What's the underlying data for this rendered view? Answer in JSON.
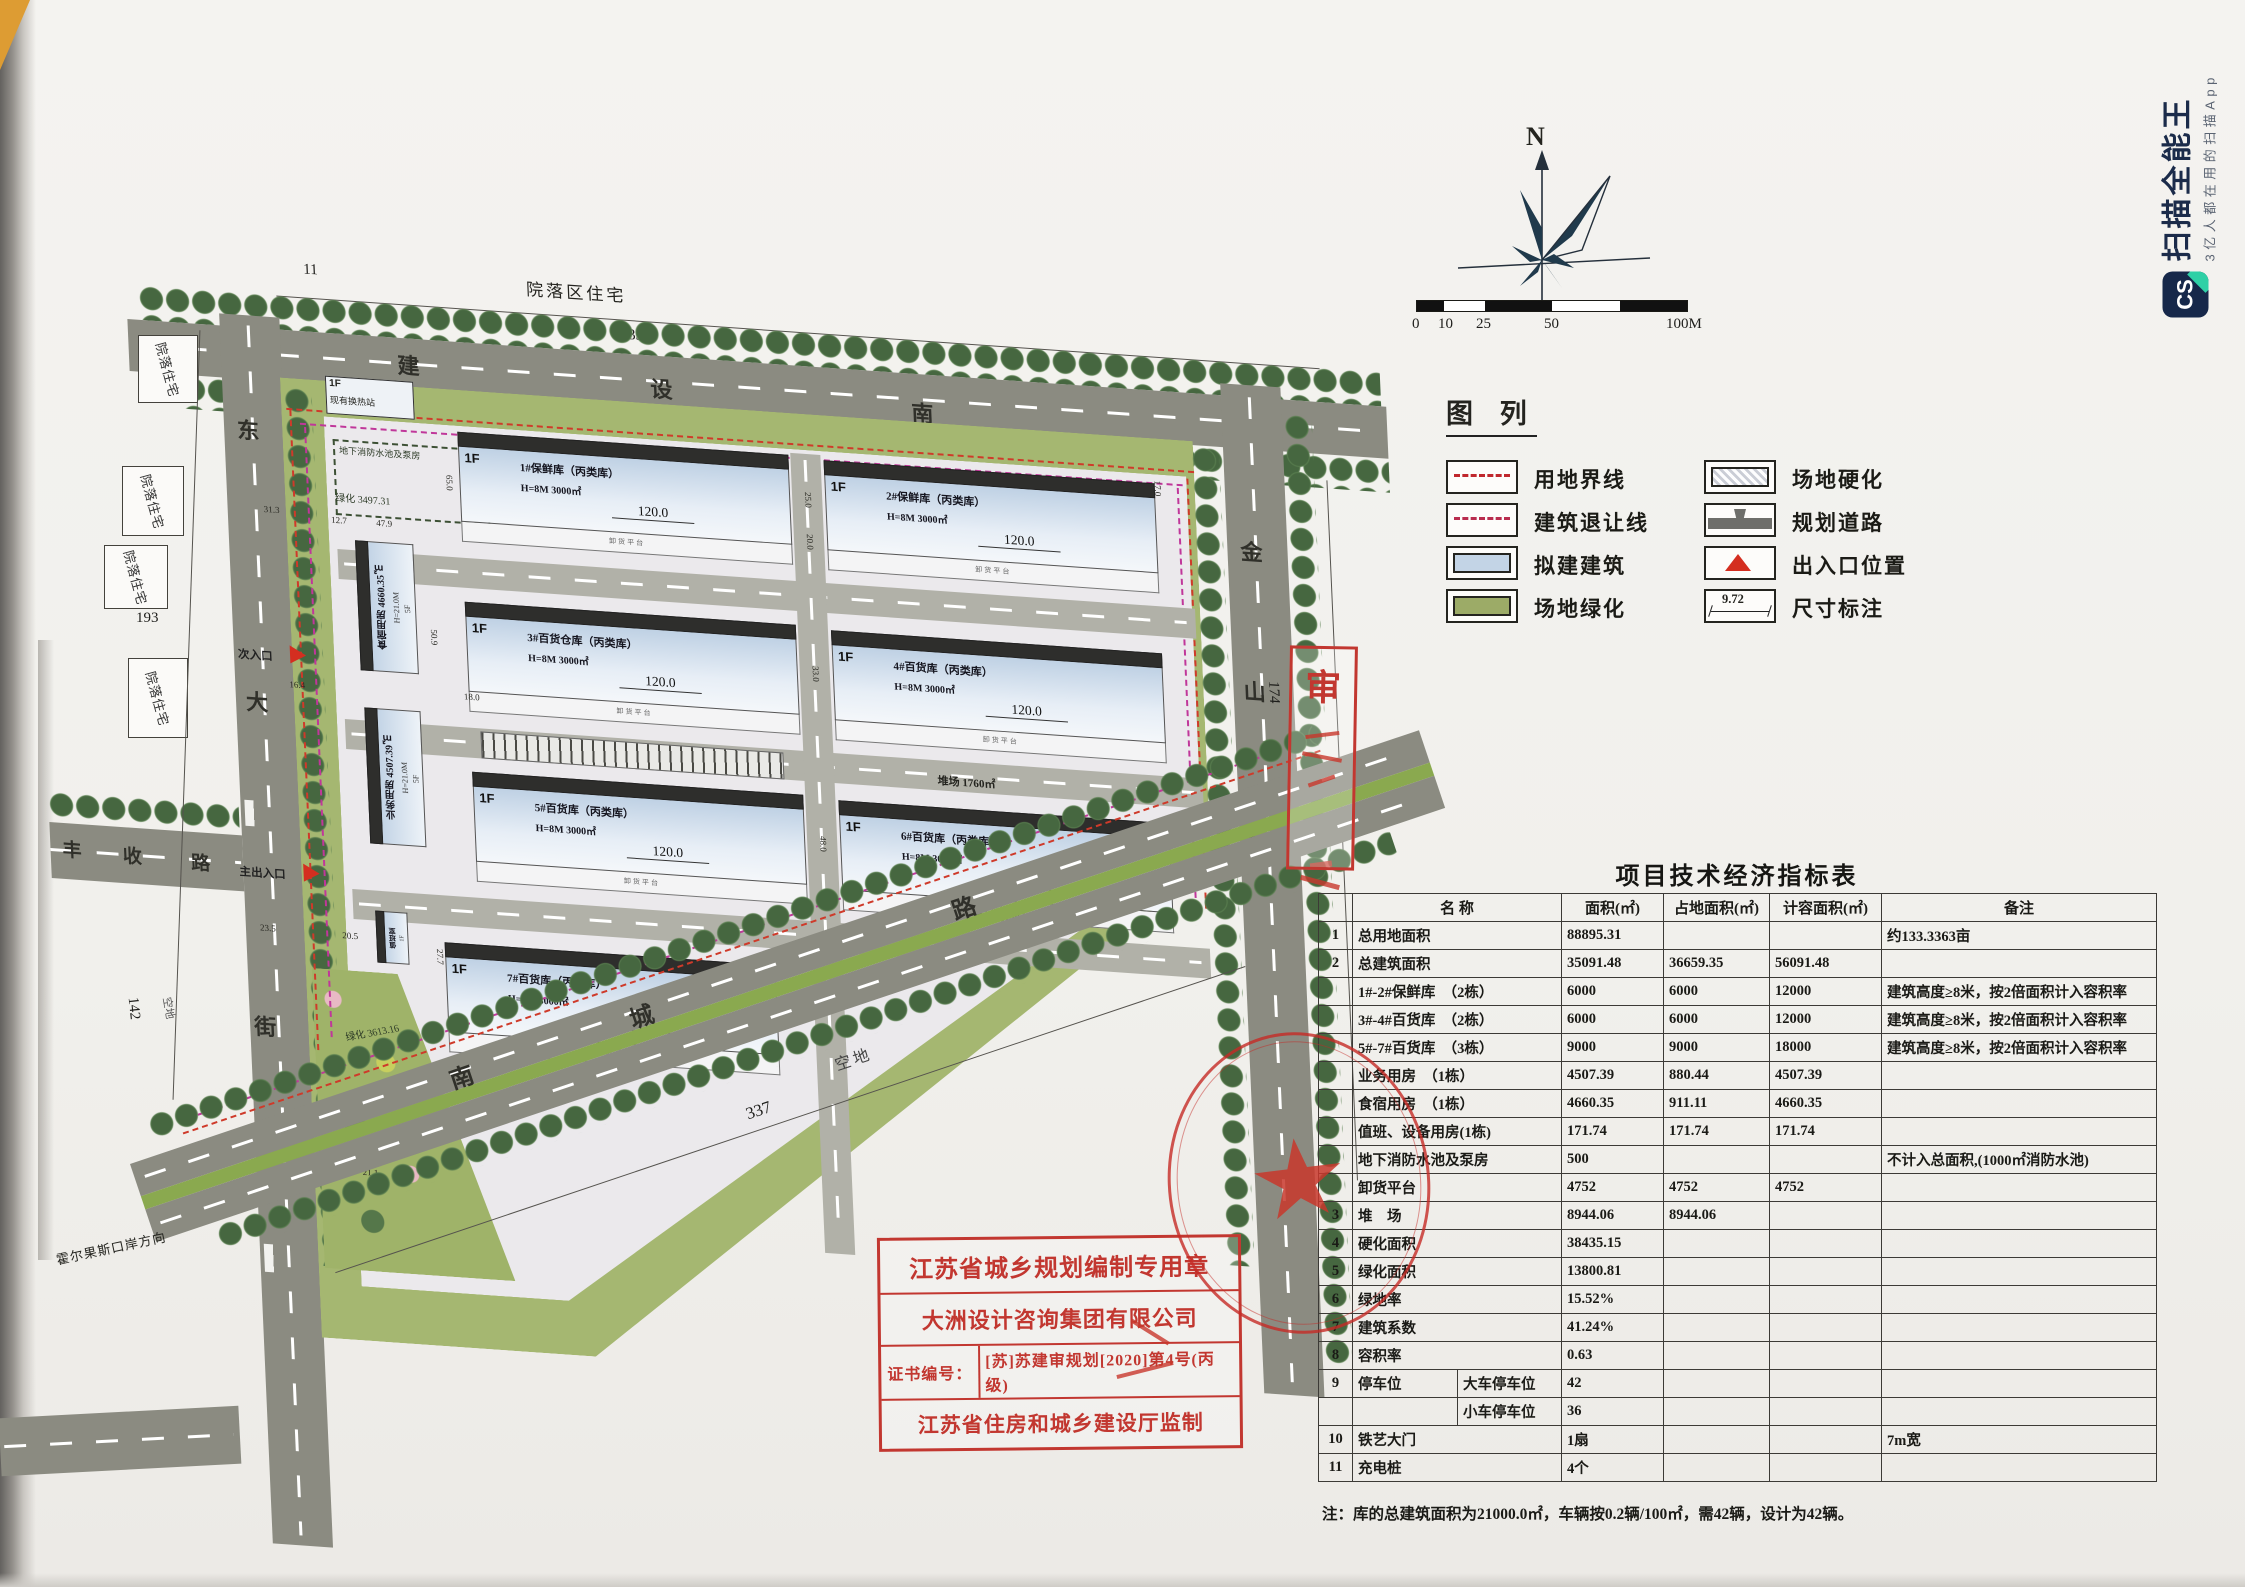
{
  "watermark": {
    "logo": "CS",
    "title": "扫描全能王",
    "subtitle": "3亿人都在用的扫描App"
  },
  "compass": {
    "n": "N"
  },
  "scale": {
    "labels": [
      "0",
      "10",
      "25",
      "50",
      "100M"
    ]
  },
  "legend": {
    "title": "图  列",
    "left": [
      "用地界线",
      "建筑退让线",
      "拟建建筑",
      "场地绿化"
    ],
    "right": [
      "场地硬化",
      "规划道路",
      "出入口位置",
      "尺寸标注"
    ],
    "dim": "9.72"
  },
  "plan": {
    "area_label": "院落区住宅",
    "residence": "院落住宅",
    "roads": {
      "top": [
        "建",
        "设",
        "南"
      ],
      "left": [
        "东",
        "大",
        "街"
      ],
      "right": [
        "金",
        "山",
        "路"
      ],
      "bottom": [
        "南",
        "城",
        "路"
      ],
      "fengshou": [
        "丰",
        "收",
        "路"
      ]
    },
    "entr": {
      "main": "主出入口",
      "sec": "次入口"
    },
    "heat": {
      "floor": "1F",
      "name": "现有换热站"
    },
    "pool": "地下消防水池及泵房",
    "green1": "绿化 3497.31",
    "green2": "绿化 3613.16",
    "yards": [
      "堆场 1760㎡",
      "堆场 3140.72㎡",
      "堆场 4043.34㎡"
    ],
    "vacant": "空地",
    "direction": "霍尔果斯口岸方向",
    "dims": {
      "t338": "338",
      "t11": "11",
      "t193": "193",
      "t142": "142",
      "t337": "337",
      "t174": "174",
      "d531": "53.1"
    },
    "dimsv": [
      "25.0",
      "20.0",
      "33.0",
      "48.0",
      "40.0",
      "17.0"
    ],
    "dims_small": [
      "12.7",
      "47.9",
      "31.3",
      "65.0",
      "50.9",
      "23.5",
      "20.5",
      "27.7",
      "21.1",
      "23.0",
      "16.4",
      "18.0"
    ],
    "warehouses": [
      {
        "floor": "1F",
        "name": "1#保鲜库（丙类库）",
        "spec": "H=8M  3000㎡",
        "dim": "120.0",
        "platform": "卸货平台"
      },
      {
        "floor": "1F",
        "name": "2#保鲜库（丙类库）",
        "spec": "H=8M  3000㎡",
        "dim": "120.0",
        "platform": "卸货平台"
      },
      {
        "floor": "1F",
        "name": "3#百货仓库（丙类库）",
        "spec": "H=8M  3000㎡",
        "dim": "120.0",
        "platform": "卸货平台"
      },
      {
        "floor": "1F",
        "name": "4#百货库（丙类库）",
        "spec": "H=8M  3000㎡",
        "dim": "120.0",
        "platform": "卸货平台"
      },
      {
        "floor": "1F",
        "name": "5#百货库（丙类库）",
        "spec": "H=8M  3000㎡",
        "dim": "120.0",
        "platform": "卸货平台"
      },
      {
        "floor": "1F",
        "name": "6#百货库（丙类库）",
        "spec": "H=8M  3000㎡",
        "dim": "120.0",
        "platform": "卸货平台"
      },
      {
        "floor": "1F",
        "name": "7#百货库（丙类库）",
        "spec": "H=8M  3000㎡",
        "dim": "120.0",
        "platform": "卸货平台"
      }
    ],
    "side": [
      {
        "name": "食宿用房 4660.35㎡",
        "floors": "5F",
        "height": "H=21.0M"
      },
      {
        "name": "业务用房 4507.39㎡",
        "floors": "5F",
        "height": "H=21.0M"
      }
    ],
    "duty": {
      "name": "值班室",
      "floor": "1F"
    }
  },
  "stamp": {
    "r1": "江苏省城乡规划编制专用章",
    "r2": "大洲设计咨询集团有限公司",
    "cert_label": "证书编号：",
    "cert_value": "[苏]苏建审规划[2020]第4号(丙级)",
    "r4": "江苏省住房和城乡建设厅监制"
  },
  "sidestamp": {
    "char": "审"
  },
  "table": {
    "title": "项目技术经济指标表",
    "note": "注：库的总建筑面积为21000.0㎡，车辆按0.2辆/100㎡，需42辆，设计为42辆。",
    "rows": [
      [
        [
          "",
          1
        ],
        [
          "名  称",
          2
        ],
        [
          "面积(㎡)",
          1
        ],
        [
          "占地面积(㎡)",
          1
        ],
        [
          "计容面积(㎡)",
          1
        ],
        [
          "备注",
          1
        ]
      ],
      [
        [
          "1",
          1
        ],
        [
          "总用地面积",
          2
        ],
        [
          "88895.31",
          1
        ],
        [
          "",
          1
        ],
        [
          "",
          1
        ],
        [
          "约133.3363亩",
          1
        ]
      ],
      [
        [
          "2",
          1
        ],
        [
          "总建筑面积",
          2
        ],
        [
          "35091.48",
          1
        ],
        [
          "36659.35",
          1
        ],
        [
          "56091.48",
          1
        ],
        [
          "",
          1
        ]
      ],
      [
        [
          "",
          1
        ],
        [
          "1#-2#保鲜库　（2栋）",
          2
        ],
        [
          "6000",
          1
        ],
        [
          "6000",
          1
        ],
        [
          "12000",
          1
        ],
        [
          "建筑高度≥8米，按2倍面积计入容积率",
          1
        ]
      ],
      [
        [
          "",
          1
        ],
        [
          "3#-4#百货库　（2栋）",
          2
        ],
        [
          "6000",
          1
        ],
        [
          "6000",
          1
        ],
        [
          "12000",
          1
        ],
        [
          "建筑高度≥8米，按2倍面积计入容积率",
          1
        ]
      ],
      [
        [
          "",
          1
        ],
        [
          "5#-7#百货库　（3栋）",
          2
        ],
        [
          "9000",
          1
        ],
        [
          "9000",
          1
        ],
        [
          "18000",
          1
        ],
        [
          "建筑高度≥8米，按2倍面积计入容积率",
          1
        ]
      ],
      [
        [
          "",
          1
        ],
        [
          "业务用房　（1栋）",
          2
        ],
        [
          "4507.39",
          1
        ],
        [
          "880.44",
          1
        ],
        [
          "4507.39",
          1
        ],
        [
          "",
          1
        ]
      ],
      [
        [
          "",
          1
        ],
        [
          "食宿用房　（1栋）",
          2
        ],
        [
          "4660.35",
          1
        ],
        [
          "911.11",
          1
        ],
        [
          "4660.35",
          1
        ],
        [
          "",
          1
        ]
      ],
      [
        [
          "",
          1
        ],
        [
          "值班、设备用房(1栋)",
          2
        ],
        [
          "171.74",
          1
        ],
        [
          "171.74",
          1
        ],
        [
          "171.74",
          1
        ],
        [
          "",
          1
        ]
      ],
      [
        [
          "",
          1
        ],
        [
          "地下消防水池及泵房",
          2
        ],
        [
          "500",
          1
        ],
        [
          "",
          1
        ],
        [
          "",
          1
        ],
        [
          "不计入总面积,(1000㎡消防水池)",
          1
        ]
      ],
      [
        [
          "",
          1
        ],
        [
          "卸货平台",
          2
        ],
        [
          "4752",
          1
        ],
        [
          "4752",
          1
        ],
        [
          "4752",
          1
        ],
        [
          "",
          1
        ]
      ],
      [
        [
          "3",
          1
        ],
        [
          "堆　场",
          2
        ],
        [
          "8944.06",
          1
        ],
        [
          "8944.06",
          1
        ],
        [
          "",
          1
        ],
        [
          "",
          1
        ]
      ],
      [
        [
          "4",
          1
        ],
        [
          "硬化面积",
          2
        ],
        [
          "38435.15",
          1
        ],
        [
          "",
          1
        ],
        [
          "",
          1
        ],
        [
          "",
          1
        ]
      ],
      [
        [
          "5",
          1
        ],
        [
          "绿化面积",
          2
        ],
        [
          "13800.81",
          1
        ],
        [
          "",
          1
        ],
        [
          "",
          1
        ],
        [
          "",
          1
        ]
      ],
      [
        [
          "6",
          1
        ],
        [
          "绿地率",
          2
        ],
        [
          "15.52%",
          1
        ],
        [
          "",
          1
        ],
        [
          "",
          1
        ],
        [
          "",
          1
        ]
      ],
      [
        [
          "7",
          1
        ],
        [
          "建筑系数",
          2
        ],
        [
          "41.24%",
          1
        ],
        [
          "",
          1
        ],
        [
          "",
          1
        ],
        [
          "",
          1
        ]
      ],
      [
        [
          "8",
          1
        ],
        [
          "容积率",
          2
        ],
        [
          "0.63",
          1
        ],
        [
          "",
          1
        ],
        [
          "",
          1
        ],
        [
          "",
          1
        ]
      ],
      [
        [
          "9",
          1
        ],
        [
          "停车位",
          1
        ],
        [
          "大车停车位",
          1
        ],
        [
          "42",
          1
        ],
        [
          "",
          1
        ],
        [
          "",
          1
        ],
        [
          "",
          1
        ]
      ],
      [
        [
          "",
          1
        ],
        [
          "",
          1
        ],
        [
          "小车停车位",
          1
        ],
        [
          "36",
          1
        ],
        [
          "",
          1
        ],
        [
          "",
          1
        ],
        [
          "",
          1
        ]
      ],
      [
        [
          "10",
          1
        ],
        [
          "铁艺大门",
          2
        ],
        [
          "1扇",
          1
        ],
        [
          "",
          1
        ],
        [
          "",
          1
        ],
        [
          "7m宽",
          1
        ]
      ],
      [
        [
          "11",
          1
        ],
        [
          "充电桩",
          2
        ],
        [
          "4个",
          1
        ],
        [
          "",
          1
        ],
        [
          "",
          1
        ],
        [
          "",
          1
        ]
      ]
    ]
  }
}
